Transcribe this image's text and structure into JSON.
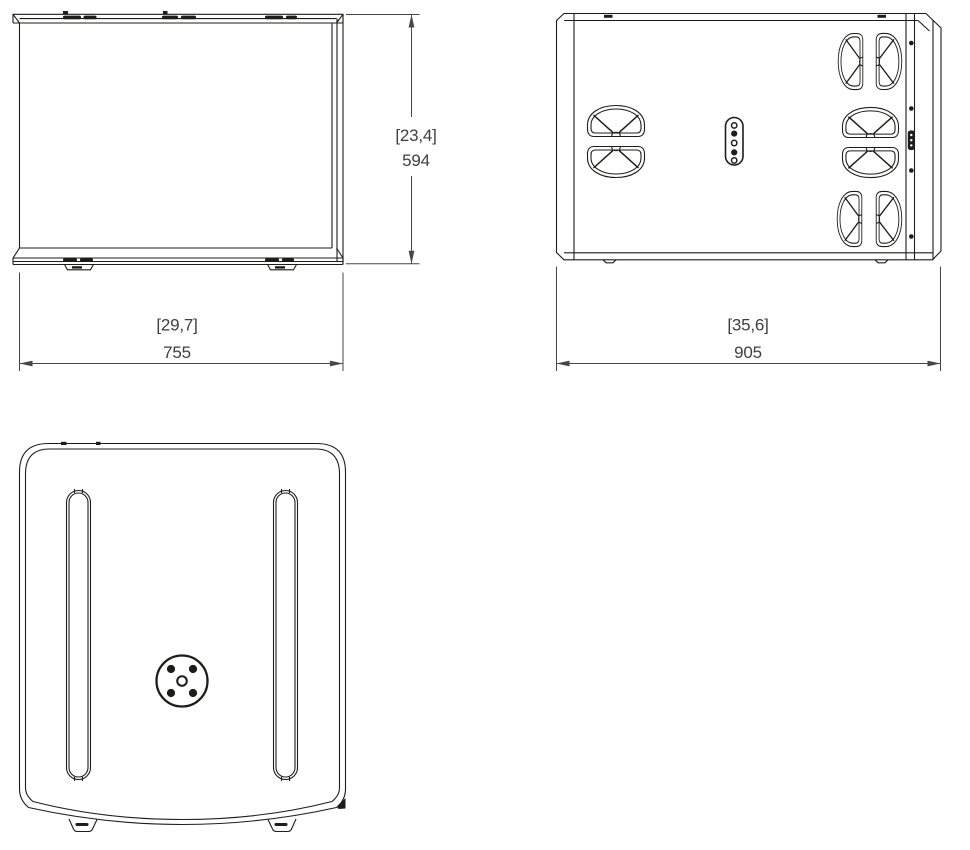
{
  "page": {
    "colors": {
      "bg": "#ffffff",
      "line": "#1d1d1b",
      "dim-line": "#474747",
      "dim-text": "#3f3f3f"
    }
  },
  "views": {
    "front": {
      "name": "front-view"
    },
    "side": {
      "name": "side-view"
    },
    "bottom": {
      "name": "bottom-view"
    }
  },
  "icons": {
    "handle": "recessed-bar-handle",
    "screw": "panel-screw",
    "connector_panel": "five-hole-connector-panel",
    "link_connector": "link-connector-strip",
    "pole_mount": "pole-mount-flange",
    "rail_slot": "rail-slot",
    "foot": "rubber-foot",
    "rigging_slot": "rigging-slot"
  },
  "dimensions": {
    "height": {
      "bracket": "[23,4]",
      "value": "594"
    },
    "front_width": {
      "bracket": "[29,7]",
      "value": "755"
    },
    "side_depth": {
      "bracket": "[35,6]",
      "value": "905"
    }
  }
}
